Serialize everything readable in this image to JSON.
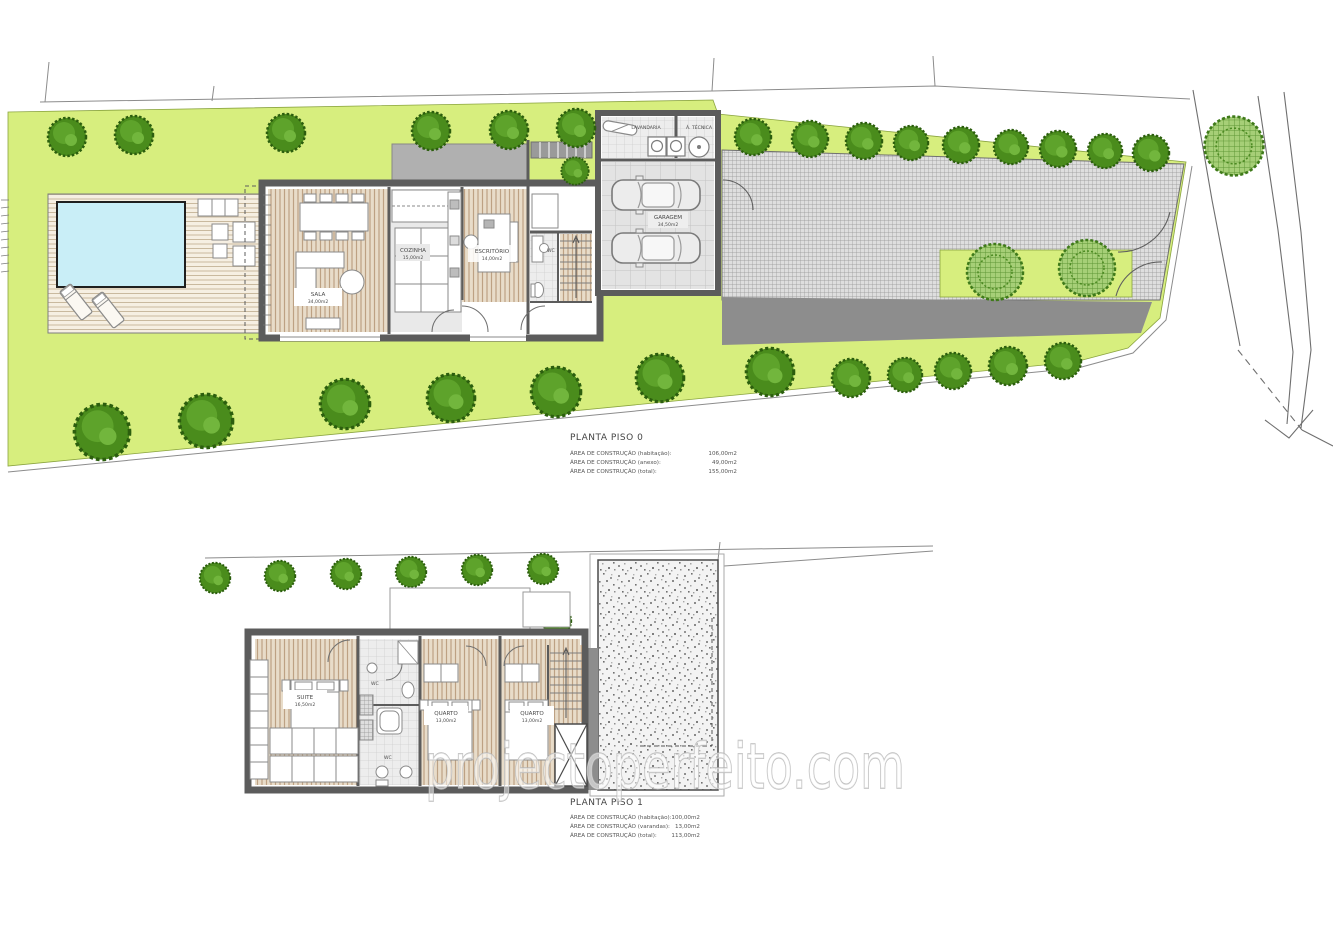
{
  "watermark": "projectoperfeito.com",
  "plan0": {
    "title": "PLANTA PISO 0",
    "areas": [
      {
        "label": "ÁREA DE CONSTRUÇÃO (habitação):",
        "value": "106,00m2"
      },
      {
        "label": "ÁREA DE CONSTRUÇÃO (anexo):",
        "value": "49,00m2"
      },
      {
        "label": "ÁREA DE CONSTRUÇÃO (total):",
        "value": "155,00m2"
      }
    ],
    "rooms": {
      "sala": {
        "name": "SALA",
        "area": "34,00m2"
      },
      "cozinha": {
        "name": "COZINHA",
        "area": "15,00m2"
      },
      "escritorio": {
        "name": "ESCRITÓRIO",
        "area": "14,00m2"
      },
      "wc": {
        "name": "WC"
      },
      "lavandaria": {
        "name": "LAVANDARIA"
      },
      "tecnica": {
        "name": "Á. TÉCNICA"
      },
      "garagem": {
        "name": "GARAGEM",
        "area": "34,50m2"
      }
    }
  },
  "plan1": {
    "title": "PLANTA PISO 1",
    "areas": [
      {
        "label": "ÁREA DE CONSTRUÇÃO (habitação):",
        "value": "100,00m2"
      },
      {
        "label": "ÁREA DE CONSTRUÇÃO (varandas):",
        "value": "13,00m2"
      },
      {
        "label": "ÁREA DE CONSTRUÇÃO (total):",
        "value": "113,00m2"
      }
    ],
    "rooms": {
      "suite": {
        "name": "SUITE",
        "area": "16,50m2"
      },
      "quarto1": {
        "name": "QUARTO",
        "area": "13,00m2"
      },
      "quarto2": {
        "name": "QUARTO",
        "area": "13,00m2"
      },
      "wc1": {
        "name": "WC"
      },
      "wc2": {
        "name": "WC"
      }
    }
  },
  "colors": {
    "lawn": "#d7ee7e",
    "pool_water": "#c9eef7",
    "wood_floor": "#e8dcc9",
    "wall": "#5c5c5c",
    "tree_green": "#4a8c1c",
    "paving": "#dcdcdc"
  }
}
